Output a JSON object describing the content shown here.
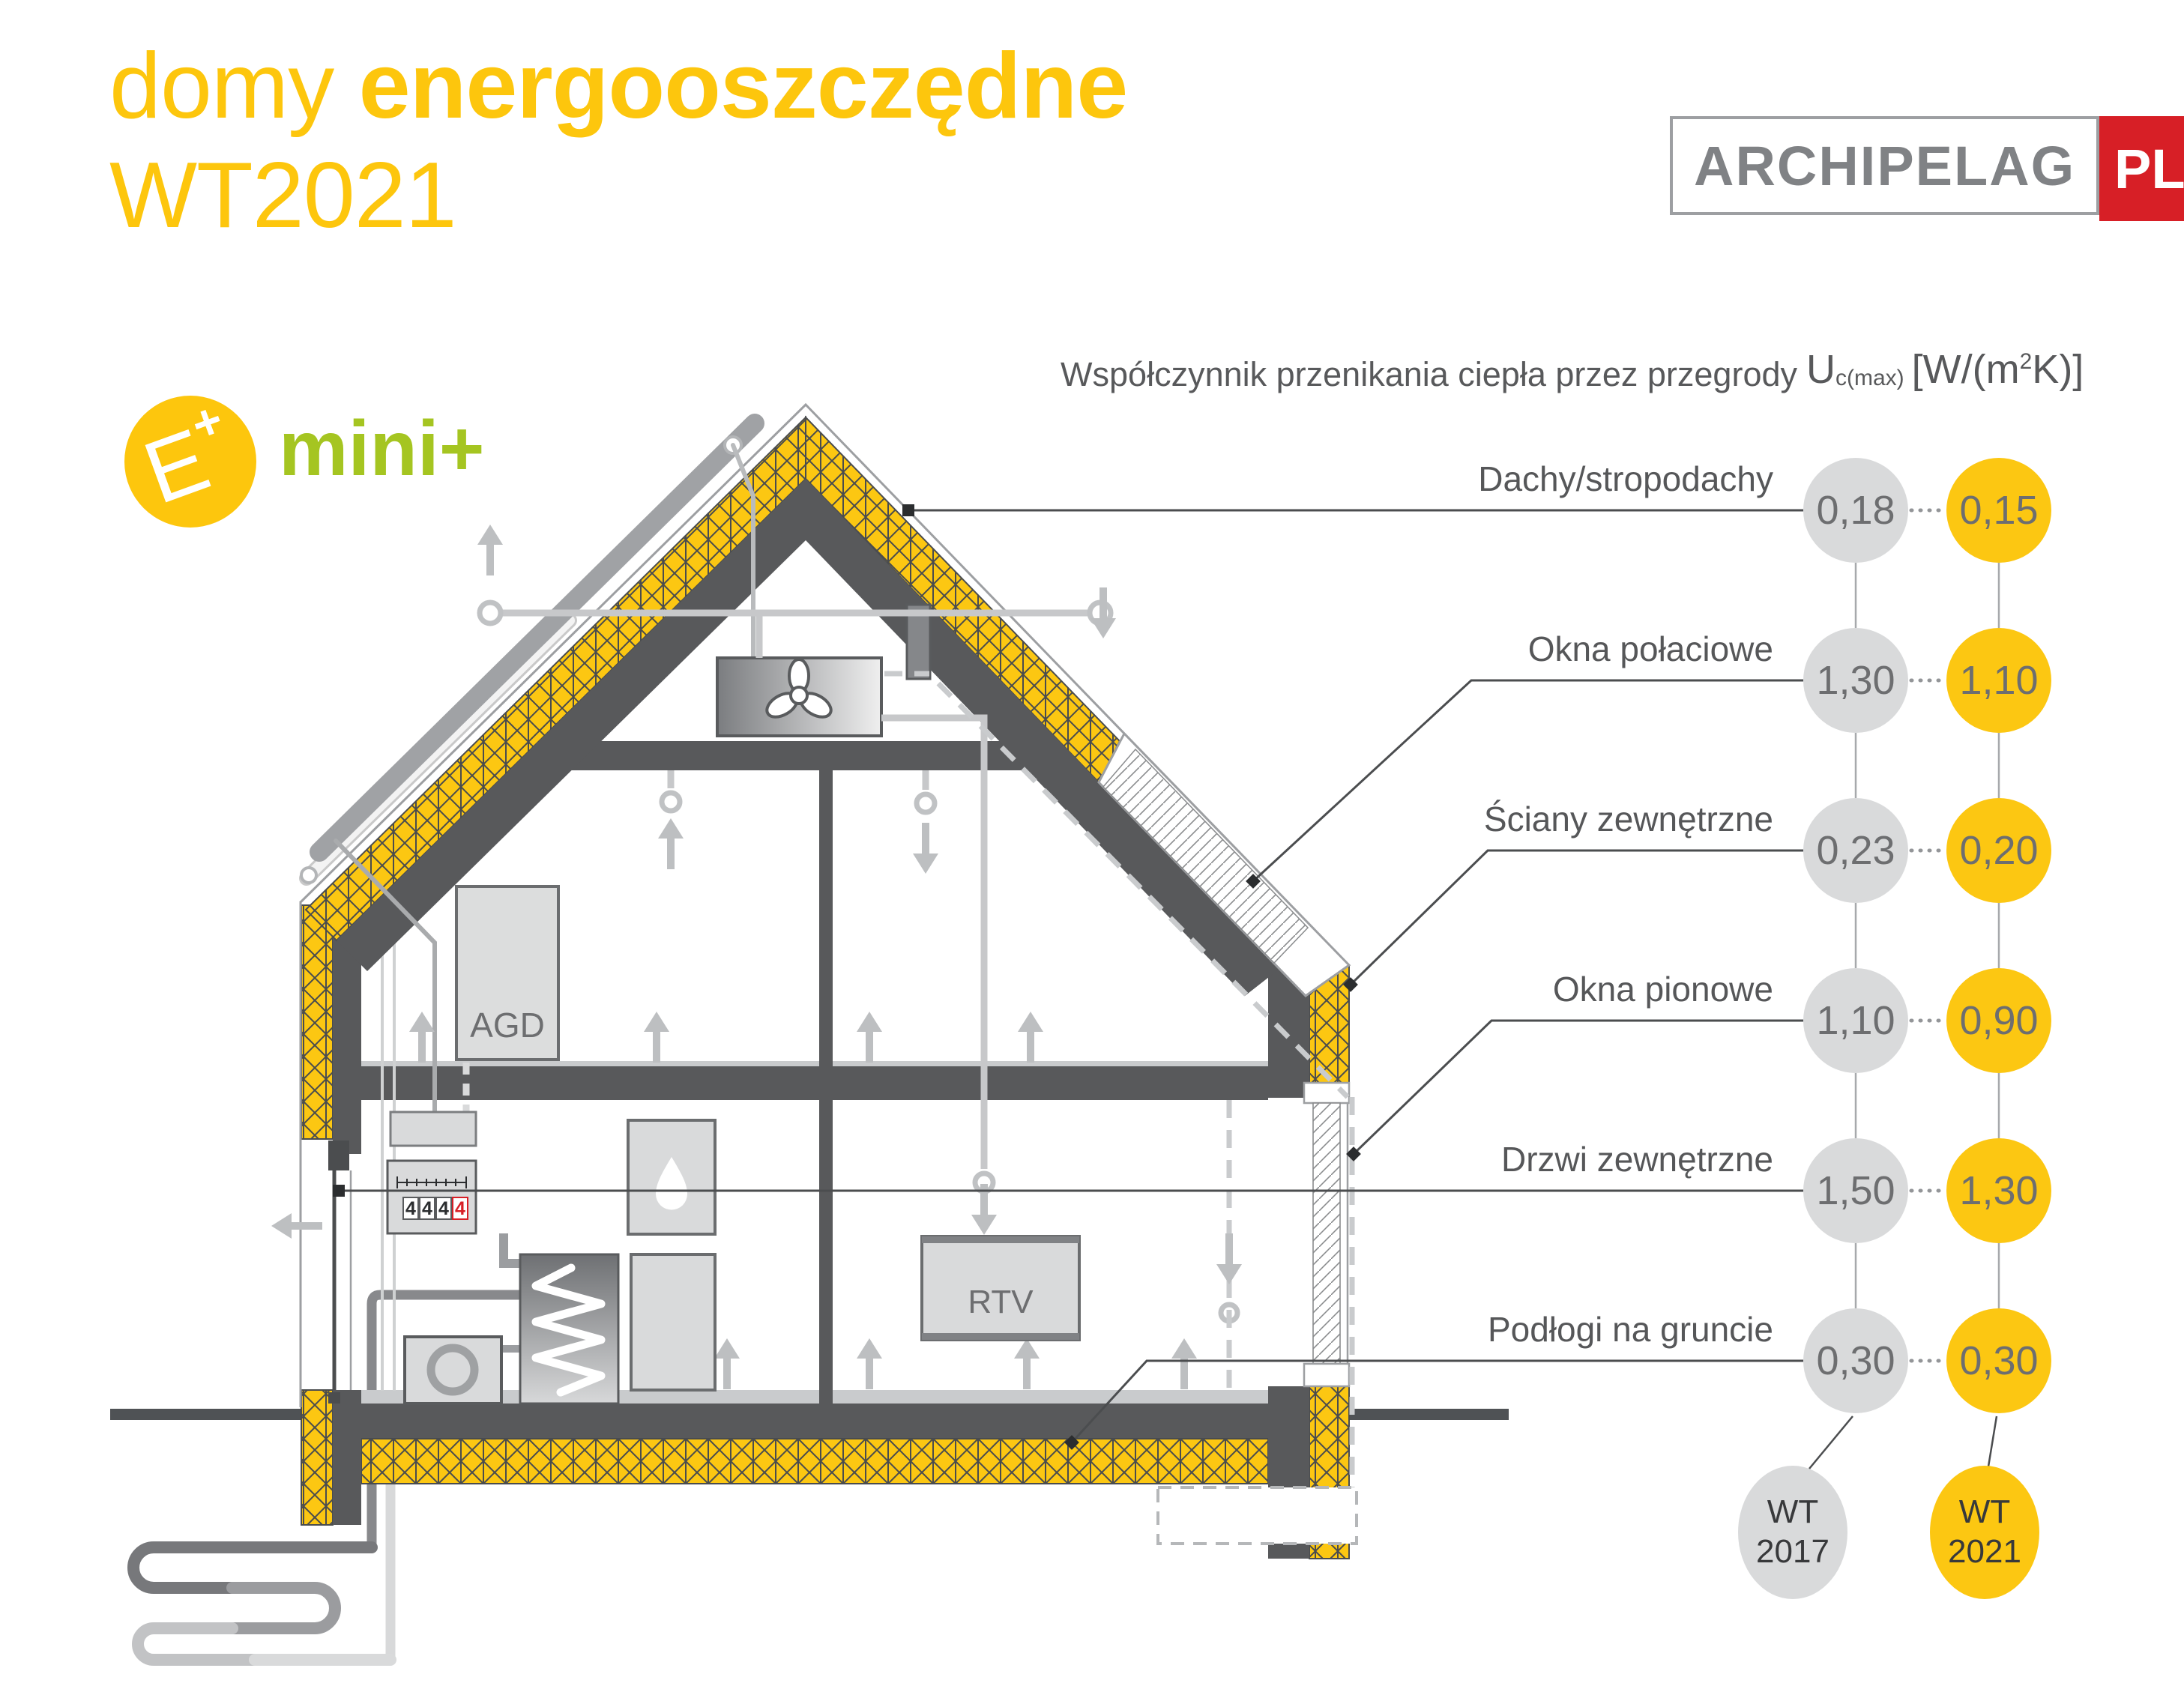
{
  "title": {
    "word_light": "domy",
    "word_bold": "energooszczędne",
    "line2": "WT2021"
  },
  "brand": {
    "name": "ARCHIPELAG",
    "tld": "PL"
  },
  "badges": {
    "e_letter": "E",
    "e_plus": "+",
    "mini": "mini+"
  },
  "header": {
    "label": "Współczynnik przenikania ciepła przez przegrody",
    "u": "U",
    "u_sub": "c(max)",
    "unit_open": "[W/(m",
    "unit_sup": "2",
    "unit_close": "K)]"
  },
  "rows": [
    {
      "label": "Dachy/stropodachy",
      "wt2017": "0,18",
      "wt2021": "0,15"
    },
    {
      "label": "Okna połaciowe",
      "wt2017": "1,30",
      "wt2021": "1,10"
    },
    {
      "label": "Ściany zewnętrzne",
      "wt2017": "0,23",
      "wt2021": "0,20"
    },
    {
      "label": "Okna pionowe",
      "wt2017": "1,10",
      "wt2021": "0,90"
    },
    {
      "label": "Drzwi zewnętrzne",
      "wt2017": "1,50",
      "wt2021": "1,30"
    },
    {
      "label": "Podłogi na gruncie",
      "wt2017": "0,30",
      "wt2021": "0,30"
    }
  ],
  "legend": {
    "old": {
      "line1": "WT",
      "line2": "2017"
    },
    "new": {
      "line1": "WT",
      "line2": "2021"
    }
  },
  "house": {
    "agd": "AGD",
    "rtv": "RTV",
    "meter_digits": [
      "4",
      "4",
      "4",
      "4"
    ]
  },
  "colors": {
    "yellow": "#fcc712",
    "gray_circle": "#d9dadb",
    "structure_dark": "#58595b",
    "green": "#a5c521",
    "red": "#d71f26",
    "text_gray": "#58595b"
  }
}
